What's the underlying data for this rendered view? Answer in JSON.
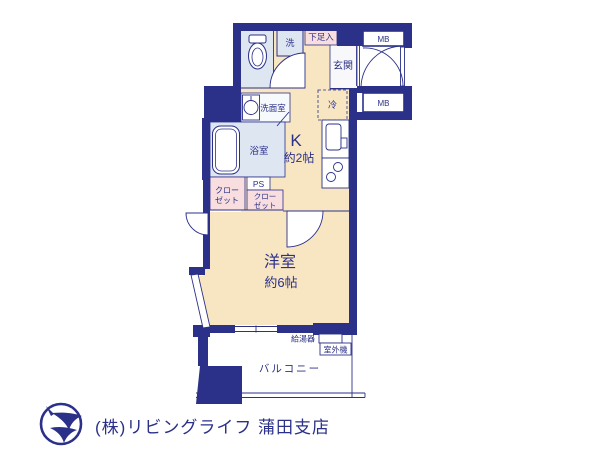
{
  "colors": {
    "wall_navy": "#2b3088",
    "floor_beige": "#f8e6c2",
    "wet_blue": "#dee6f2",
    "closet_pink": "#f8dede",
    "white": "#ffffff",
    "label_navy": "#2b3088",
    "footer_gray": "#cccccc"
  },
  "rooms": {
    "laundry": {
      "label": "洗"
    },
    "shoe_box": {
      "label": "下足入"
    },
    "entrance": {
      "label": "玄関"
    },
    "mb_top": {
      "label": "MB"
    },
    "mb_bottom": {
      "label": "MB"
    },
    "washroom": {
      "label": "洗面室"
    },
    "bathroom": {
      "label": "浴室"
    },
    "refrigerator": {
      "label": "冷"
    },
    "kitchen": {
      "label": "K",
      "size": "約2帖"
    },
    "closet1": {
      "line1": "クロー",
      "line2": "ゼット"
    },
    "ps": {
      "label": "PS"
    },
    "closet2": {
      "line1": "クロー",
      "line2": "ゼット"
    },
    "western_room": {
      "label": "洋室",
      "size": "約6帖"
    },
    "water_heater": {
      "label": "給湯器"
    },
    "outdoor_unit": {
      "label": "室外機"
    },
    "balcony": {
      "label": "バルコニー"
    }
  },
  "footer": {
    "company": "(株)リビングライフ 蒲田支店"
  }
}
